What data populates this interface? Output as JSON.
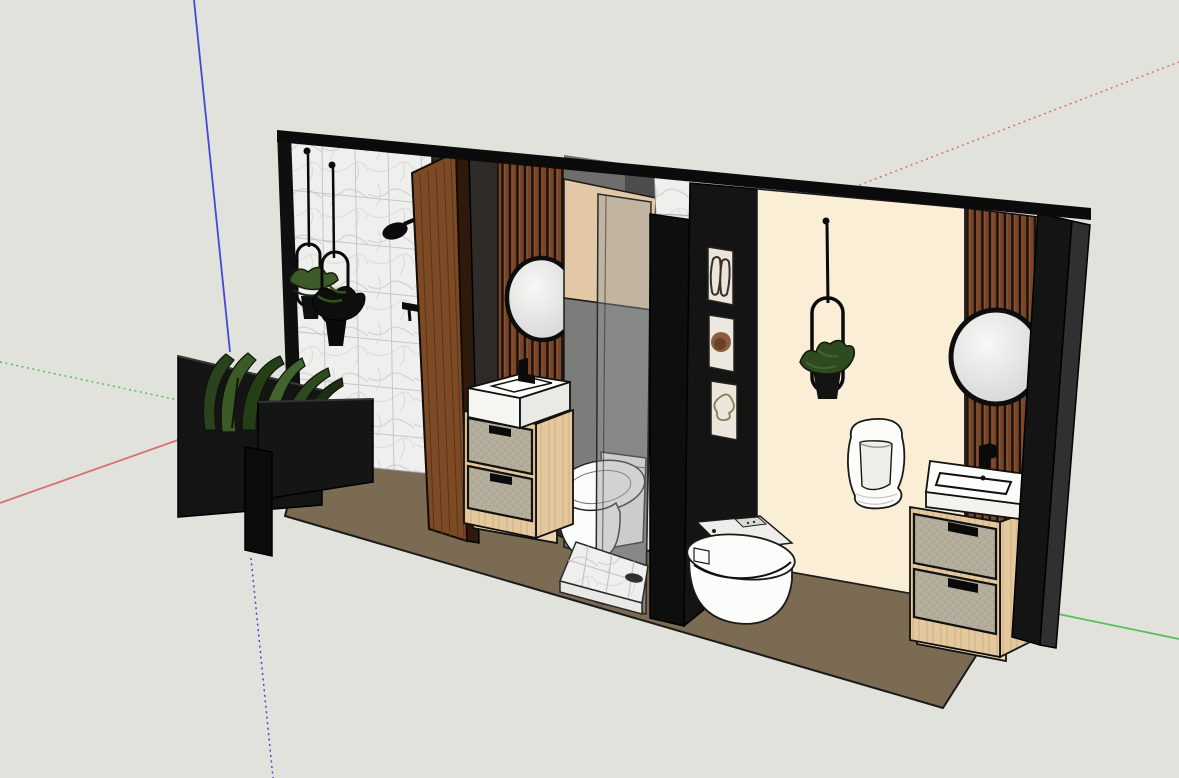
{
  "app": {
    "type": "3d-modeler-viewport",
    "content": "Interior model of two small bathrooms viewed in axonometric perspective"
  },
  "viewport": {
    "width": 1179,
    "height": 778,
    "background": "#E2E2DD"
  },
  "axes": {
    "red": "#D97070",
    "green": "#58BE5B",
    "blue": "#4646D8"
  },
  "materials": {
    "floor": "#7B6B53",
    "cream_wall": "#FBEED6",
    "beige_panel": "#E2C8A7",
    "charcoal_wall": "#2E2B28",
    "black_wall": "#141414",
    "shower_gray": "#7C7C7A",
    "door_wood": "#7D4A26",
    "slat_wood": "#7A4526",
    "vanity_wood": "#E5C99E",
    "drawer_fabric": "#B5AE9C",
    "marble": "#EFEFED",
    "fixture_white": "#FCFCFA",
    "plant_green": "#3C5A26",
    "tray_marble": "#DCDCD8"
  },
  "scene": {
    "objects": [
      "drawing axes (red / green / blue)",
      "brown floor slab",
      "marble tiled shower wall",
      "two hanging plant hoops on marble wall",
      "black shower head and mixer valve",
      "black planter half-wall with banana plants",
      "open wooden entry door",
      "charcoal wall with wood slat panel",
      "round mirror over washbasin vanity (left bath)",
      "two-drawer washbasin vanity (left bath)",
      "toilet (left bath)",
      "glass shower enclosure with beige bulkhead",
      "marble shower tray with drain",
      "black partition wall",
      "three framed artworks",
      "cream feature wall",
      "hanging plant on cream wall",
      "wall-hung urinal",
      "smart toilet (right bath)",
      "wood slat accent wall with round mirror (right bath)",
      "two-drawer washbasin vanity (right bath)",
      "black end wall"
    ]
  }
}
